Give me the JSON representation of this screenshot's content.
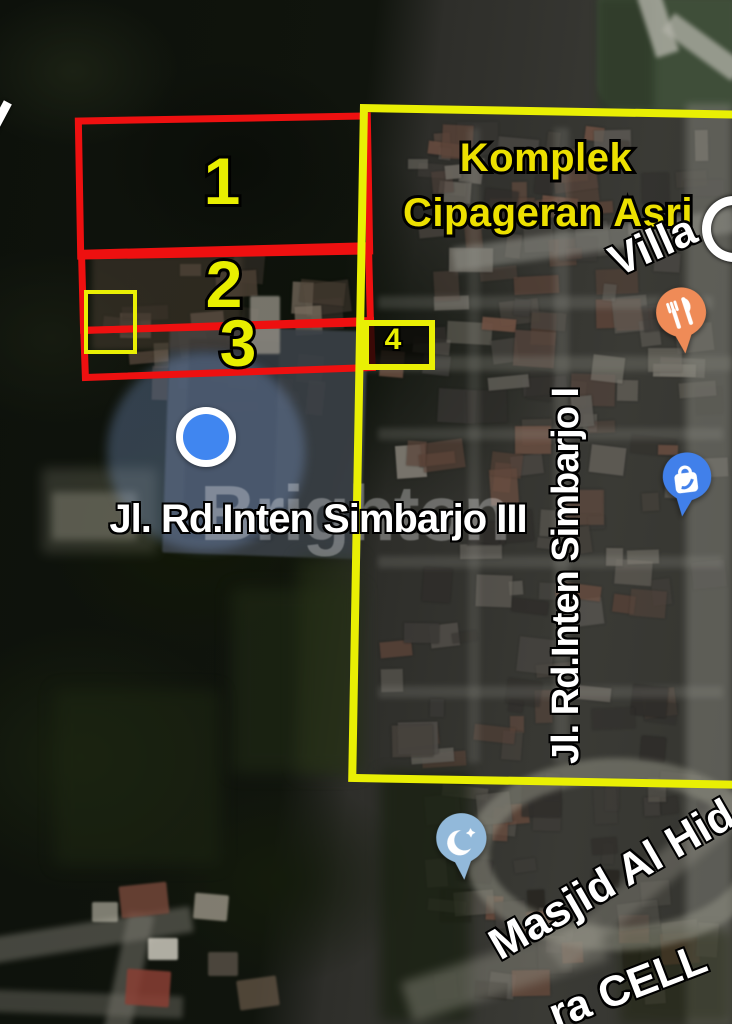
{
  "map": {
    "area_label": {
      "line1": "Komplek",
      "line2": "Cipageran Asri"
    },
    "plot_markers": {
      "plot1": "1",
      "plot2": "2",
      "plot3": "3",
      "plot4": "4"
    },
    "roads": {
      "simbarjo3": "Jl. Rd.Inten Simbarjo III",
      "simbarjo1": "Jl. Rd.Inten Simbarjo I",
      "villa": "Villa",
      "masjid": "Masjid Al Hid",
      "cell": "ra CELL"
    },
    "watermark": "Brighton",
    "pins": {
      "restaurant": {
        "name": "restaurant-pin",
        "color": "#ef8b57"
      },
      "shopping": {
        "name": "shopping-pin",
        "color": "#4180ea"
      },
      "mosque": {
        "name": "mosque-pin",
        "color": "#92b9da"
      }
    },
    "colors": {
      "plot_red": "#ee1010",
      "annotation_yellow": "#e9ef04",
      "label_yellow": "#ece000",
      "location_blue": "#4086f0"
    }
  }
}
